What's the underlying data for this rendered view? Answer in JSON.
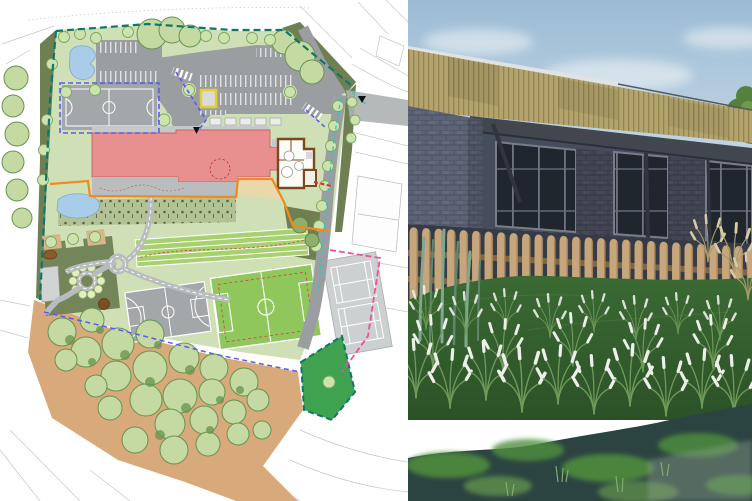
{
  "image": {
    "kind": "composite-press-image",
    "left_panel": "architectural site masterplan of a school campus",
    "right_panel": "3D exterior render of single-storey school building behind picket fence and wetland planting"
  },
  "site_plan_features": [
    "boundary-line-teal",
    "woodland-trees",
    "ground-tan",
    "car-park-bays",
    "access-road",
    "muga-court",
    "basketball-court",
    "football-pitch",
    "tennis-courts",
    "running-track",
    "school-building-red",
    "nursery-building-brown",
    "terraces",
    "ponds",
    "footpaths",
    "garden-with-shrub-ring",
    "planting-strip",
    "habitat-parcel-green",
    "pedestrian-crossings"
  ],
  "render_features": [
    "sky-with-clouds",
    "timber-clad-fascia",
    "roof-coping",
    "dark-canopy",
    "blue-brick-walls",
    "glazed-windows",
    "structural-posts",
    "timber-picket-fence",
    "grass-mound",
    "ornamental-grasses-white-plumes",
    "reed-planting",
    "pampas-grass",
    "wetland-pond-with-algae"
  ],
  "palette": {
    "planBackground": "#ffffff",
    "planSurvey": "#c6c6c6",
    "planSiteGreen": "#cfe0b6",
    "planVergeOlive": "#6e7f51",
    "planGardenOlive": "#75855a",
    "planBoundaryTeal": "#0f766e",
    "planPondBlue": "#a9cde9",
    "planAsphalt": "#9b9ea1",
    "planCourtGray": "#a4a7aa",
    "planTennisGray": "#cdd0d1",
    "planTrackGreen": "#a7d06e",
    "planPitchGreen": "#90c75c",
    "planBuildingRed": "#e89090",
    "planBrown": "#7a4a1f",
    "planTerraceTan": "#ead8ad",
    "planOrange": "#f28a1c",
    "planPathGray": "#b9bcbe",
    "planTreeLight": "#cde3ae",
    "planTreeStroke": "#7da85e",
    "planWoodlandGreen": "#c4daa2",
    "planWoodlandStroke": "#67934f",
    "planGroundTan": "#d8a97b",
    "planParcelGreen": "#3fa251",
    "planBlueDash": "#5b5bf0",
    "planCyanDash": "#35c4c4",
    "planPinkDash": "#ef4f98",
    "planRedDash": "#e03030",
    "planYellow": "#e3cf2e",
    "photoSkyTop": "#9cbbd4",
    "photoSkyBottom": "#dde8ee",
    "photoCloud": "#f2f6f8",
    "photoTimber": "#b3a46d",
    "photoTimberStripe": "#8d7d4c",
    "photoCoping": "#dfe3e3",
    "photoCanopy": "#41464f",
    "photoBrick": "#5c6375",
    "photoBrickDark": "#4a5062",
    "photoShadowWall": "#454c5b",
    "photoGlass": "#20262e",
    "photoMullion": "#6e7580",
    "photoFence": "#c6a67a",
    "photoFenceShade": "#a08058",
    "photoRail": "#7d6749",
    "photoFenceBack": "#343a46",
    "photoGrassDark": "#2c5128",
    "photoGrassMid": "#3a6a33",
    "photoBlade": "#6f9a5a",
    "photoPlume": "#edefe9",
    "photoReed": "#7fa88f",
    "photoPampas": "#a89a6e",
    "photoPampasPlume": "#d8cba4",
    "photoPond": "#2b4441",
    "photoAlgae": "#4f8f3d",
    "photoAlgaeLight": "#72aa4f",
    "photoFoliage": "#55803d"
  }
}
